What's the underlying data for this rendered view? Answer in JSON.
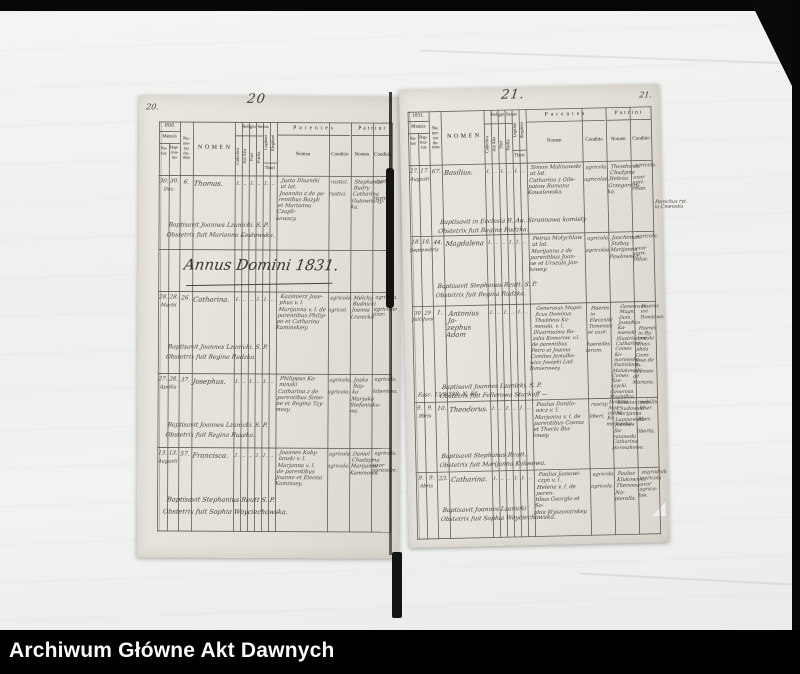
{
  "archive_bar": {
    "title": "Archiwum Główne Akt Dawnych"
  },
  "header_labels": {
    "mensis": "Mensis",
    "natus": "Na-\ntus",
    "baptisatus": "Bap-\ntisa-\ntus",
    "numerus_domus": "Nu-\nme-\nrus\ndo-\nmus",
    "nomen": "NOMEN",
    "religio": "Religio",
    "catholica": "Catholica",
    "aut_alia": "Aut Alia",
    "sexus": "Sexus",
    "puer": "Puer",
    "puella": "Puella.",
    "legitimi": "Legitimi",
    "illegitimi": "Illegitimi",
    "thori": "Thori",
    "parentes": "Parentes",
    "patrini": "Patrini",
    "sub_nomen": "Nomen",
    "sub_conditio": "Conditio"
  },
  "left_page": {
    "corner": "20.",
    "number": "20",
    "year": "1830.",
    "annus_heading": "Annus Domini 1831.",
    "rows": [
      {
        "dn": "30.",
        "db": "30.",
        "month": "Dec.",
        "mn": "",
        "mb": "",
        "house": "6.",
        "name": "Thomas.",
        "marks": [
          "1.",
          "‥",
          "1.",
          "‥",
          "1.",
          "‥"
        ],
        "parents": "Justa Dluzniki\nut lat.\nJoannita z de pa-\nrentibus Bazyli\net Marianna Czapli-\nkowscy.",
        "parents_conditio": "rustici.\n\nrustici.",
        "patrini": "Stephanus\nBudry\nCatharina\nGutowinczy-\nka.",
        "patrini_conditio": "rustici.\n\n\nrustici.",
        "baptizer_line1": "Baptisavit Joannes Lzanicki. S. P.",
        "baptizer_line2": "Obstetrix fuit Marianna Kostowska."
      },
      {
        "dn": "28.",
        "db": "28.",
        "month": "Martii",
        "mn": "",
        "mb": "",
        "house": "26.",
        "name": "Catharina.",
        "marks": [
          "1.",
          "‥",
          "‥",
          "1.",
          "1.",
          "‥"
        ],
        "parents": "Kazimierz Joze-\nphus v. l.\nMarijanna v. l. de\nparentibus Philip-\npo et Catharina\nKaminskiey.",
        "parents_conditio": "agricola.\n\nagricol.",
        "patrini": "Melchy\nBudnicki\nJoanna\nLranicka.",
        "patrini_conditio": "agricola.\n\nagricolae\nuxor.",
        "baptizer_line1": "Baptisavit Joannes Lzanicki. S. P.",
        "baptizer_line2": "Obstetrix fuit Regina Rudzka."
      },
      {
        "dn": "27.",
        "db": "28.",
        "month": "Aprilis",
        "mn": "",
        "mb": "",
        "house": "37.",
        "name": "Josephus.",
        "marks": [
          "1.",
          "‥",
          "1.",
          "‥",
          "1.",
          "‥"
        ],
        "parents": "Philippus Ka-\nminski\nCatharina z de\nparentibus Simo-\nne et Regina Tzy-\nmosy.",
        "parents_conditio": "agricola.\n\nagricola.",
        "patrini": "Jozko Bay-\nko\nMaryska\nStefaniuko-\nwa.",
        "patrini_conditio": "agricola.\n\nlaboriosa.",
        "baptizer_line1": "Baptisavit Joannes Lzanicki. S. P.",
        "baptizer_line2": "Obstetrix fuit Regina Ruszka."
      },
      {
        "dn": "13.",
        "db": "13.",
        "month": "Augusti",
        "mn": "",
        "mb": "",
        "house": "57.",
        "name": "Francisca.",
        "marks": [
          "1.",
          "‥",
          "‥",
          "1.",
          "1.",
          "‥"
        ],
        "parents": "Joannes Koby-\nlanski v. l.\nMarjanna v. l.\nde parentibus\nJoanne et Eleona\nKaminsey.",
        "parents_conditio": "agricola.\n\nagricola.",
        "patrini": "Daniel\nChudzyma\nMarijanna\nKaminowa.",
        "patrini_conditio": "agricola.\n\nuxor\nagricolae.",
        "baptizer_line1": "Baptisavit Stephanius Reutt S. P.",
        "baptizer_line2": "Obstetrix fuit Sophia Woyciechowska."
      }
    ]
  },
  "right_page": {
    "corner": "21.",
    "number": "21.",
    "year": "1831.",
    "rows": [
      {
        "dn": "27.",
        "db": "17.",
        "month": "Augusti",
        "mn": "",
        "mb": "",
        "house": "67.",
        "name": "Basilius.",
        "marks": [
          "1.",
          "‥",
          "1.",
          "‥",
          "1.",
          "‥"
        ],
        "parents": "Simon Malinowski\nut lat.\nCatharina z Gile-\npatow Romana\nKowalewska.",
        "parents_conditio": "agricola.\n\nagricolae.",
        "patrini": "Theodorus\nChudyma\nHelena\nGrzegorczy-\nka.",
        "patrini_conditio": "agricola.\n\nuxor agri-\ncolae.",
        "side_note": "Parochus ryt.\nin Cmensku",
        "baptizer_line1": "Baptisavit in Ecclesia R. Au. Strannowa komisty",
        "baptizer_line2": "Obstetrix fuit Regina Rudzka."
      },
      {
        "dn": "18.",
        "db": "18.",
        "month": "Septembris",
        "mn": "",
        "mb": "",
        "house": "44.",
        "name": "Magdalena",
        "marks": [
          "1.",
          "‥",
          "‥",
          "1.",
          "1.",
          "‥"
        ],
        "parents": "Petrus Motychlow\nut lat.\nMarijanna z de\nparentibus Joan-\nne et Urszula Jan-\nkowey.",
        "parents_conditio": "agricola.\n\nagricolae.",
        "patrini": "Joachimus\nStabay\nMarijanna\nPawlowska.",
        "patrini_conditio": "agricola.\n\nuxor agri-\ncolae.",
        "baptizer_line1": "Baptisavit Stephanus Reutt. S. P.",
        "baptizer_line2": "Obstetrix fuit Regina Rudzka."
      },
      {
        "dn": "30",
        "db": "29",
        "month": "",
        "mn": "Julii",
        "mb": "Junii",
        "house": "1.",
        "name": "Antonius Jo-\nzephus Adam",
        "marks": [
          "1.",
          "‥",
          "1.",
          "‥",
          "1.",
          "‥"
        ],
        "parents": "Generosus Magni-\nficus Dominus\nThaddeus Ka-\nmenski, v. l.\nIllustrissima Ro-\nzalia Komorow. v.l.\nde parentibus\nPetro et Joanna\nComites Jamulko-\nwicz Josephi Lad.\nTomierowey.",
        "parents_conditio": "Haeres in\nEleczniki\nTomensis\net uxor.\n\nhaeredes\nlarum.",
        "patrini": "Generosus\nMagn. Dom.\nJosephus Ka-\nmienski\nIllustrissima\nCatharina\nComes Ko-\nmorowska.\nStanislaus\nMalakowski\nComes Rze-\nczycki.\nGenerosa\nMagnifica\nDomina Mar-\ncelina Ko-\nmorowska.",
        "patrini_conditio": "Haeres est\nTomilowo.\n\nHaeres in By-\ntomski Theo-\nphila Comi-\ntissa de To-\nmienses\nad Mariana.",
        "note": "Fasc. 13/9 598. N. 84.",
        "baptizer_line1": "Baptisavit Joannes Lzanicki. S. P.",
        "baptizer_line2": "Obstetrix fuit Fellerowa Stuckoff —"
      },
      {
        "dn": "9.",
        "db": "9.",
        "month": "9bris",
        "mn": "",
        "mb": "",
        "house": "10.",
        "name": "Theodorus.",
        "marks": [
          "1.",
          "‥",
          "1.",
          "‥",
          "1.",
          "‥"
        ],
        "parents": "Paulus Danilo-\nwicz v. l.\nMarjanna v. l. de\nparentibus Cosma\net Thecla Bia-\nlowey.",
        "parents_conditio": "rusczy.\n\nliberi.",
        "patrini": "Konstantinus\nChudowski\nMarijanna\nLapinowska\nJoannes Ba-\nranowski\nCatharina\nHoroszkowa.",
        "patrini_conditio": "nobilis\nliber.\n\nliber.\n\nliberta.",
        "baptizer_line1": "Baptisavit Stephanus Reutt.",
        "baptizer_line2": "Obstetrix fuit Marijanna Kolosowa."
      },
      {
        "dn": "9.",
        "db": "9.",
        "month": "9bris",
        "mn": "",
        "mb": "",
        "house": "23.",
        "name": "Catharina.",
        "marks": [
          "1.",
          "‥",
          "‥",
          "1.",
          "1.",
          "‥"
        ],
        "parents": "Paulus Jassowi-\nczyn v. l.\nHelena v. l. de paren-\ntibus Georgio et So-\nphia Wyszomirskey.",
        "parents_conditio": "agricola.\n\nagricola.",
        "patrini": "Paulus\nKlukowski\nTheressa Na-\npieralla.",
        "patrini_conditio": "zagrodnik\nagricola\nuxor agrico-\nlae.",
        "baptizer_line1": "Baptisavit Joannes Lzanicki",
        "baptizer_line2": "Obstetrix fuit Sophia Woyciechowska."
      }
    ]
  }
}
